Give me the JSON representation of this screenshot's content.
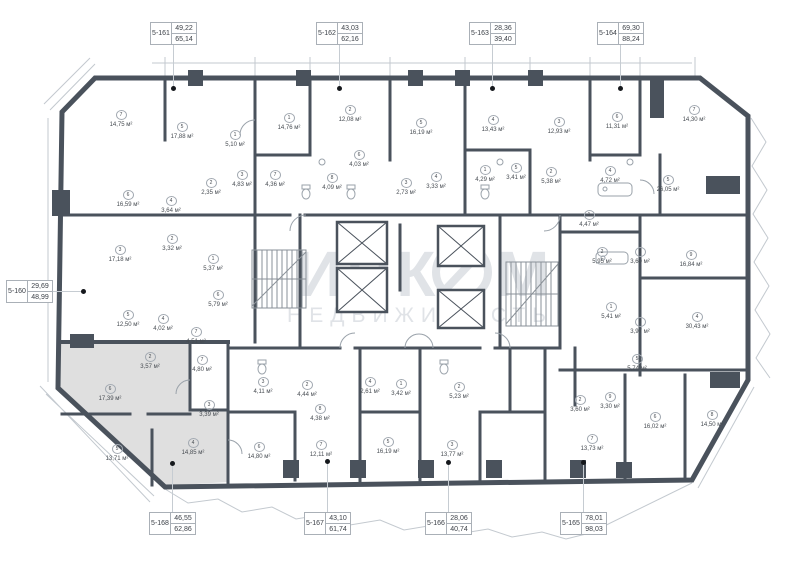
{
  "plan": {
    "area_unit": "м²",
    "watermark": {
      "brand_left": "ИНК",
      "brand_right": "М",
      "subtitle": "НЕДВИЖИМОСТЬ"
    },
    "colors": {
      "wall": "#4a525c",
      "selected_fill": "#dfdfdf",
      "leader_dot": "#15181c",
      "thin_line": "#c3c9cf"
    },
    "selected_unit": "5-168",
    "units": [
      {
        "id": "5-160",
        "living": "29,69",
        "total": "48,99",
        "box": [
          6,
          280
        ],
        "dot": [
          83,
          291
        ],
        "dir": "right"
      },
      {
        "id": "5-161",
        "living": "49,22",
        "total": "65,14",
        "box": [
          150,
          22
        ],
        "dot": [
          173,
          88
        ],
        "dir": "down"
      },
      {
        "id": "5-162",
        "living": "43,03",
        "total": "62,16",
        "box": [
          316,
          22
        ],
        "dot": [
          339,
          88
        ],
        "dir": "down"
      },
      {
        "id": "5-163",
        "living": "28,36",
        "total": "39,40",
        "box": [
          469,
          22
        ],
        "dot": [
          492,
          88
        ],
        "dir": "down"
      },
      {
        "id": "5-164",
        "living": "69,30",
        "total": "88,24",
        "box": [
          597,
          22
        ],
        "dot": [
          620,
          88
        ],
        "dir": "down"
      },
      {
        "id": "5-165",
        "living": "78,01",
        "total": "98,03",
        "box": [
          560,
          512
        ],
        "dot": [
          583,
          462
        ],
        "dir": "up"
      },
      {
        "id": "5-166",
        "living": "28,06",
        "total": "40,74",
        "box": [
          425,
          512
        ],
        "dot": [
          448,
          462
        ],
        "dir": "up"
      },
      {
        "id": "5-167",
        "living": "43,10",
        "total": "61,74",
        "box": [
          304,
          512
        ],
        "dot": [
          327,
          461
        ],
        "dir": "up"
      },
      {
        "id": "5-168",
        "living": "46,55",
        "total": "62,86",
        "box": [
          149,
          512
        ],
        "dot": [
          172,
          463
        ],
        "dir": "up"
      }
    ],
    "rooms": [
      {
        "n": "7",
        "a": "14,75",
        "x": 121,
        "y": 108
      },
      {
        "n": "5",
        "a": "17,88",
        "x": 182,
        "y": 120
      },
      {
        "n": "1",
        "a": "5,10",
        "x": 235,
        "y": 128
      },
      {
        "n": "6",
        "a": "16,59",
        "x": 128,
        "y": 188
      },
      {
        "n": "4",
        "a": "3,64",
        "x": 171,
        "y": 194
      },
      {
        "n": "2",
        "a": "2,35",
        "x": 211,
        "y": 176
      },
      {
        "n": "3",
        "a": "4,83",
        "x": 242,
        "y": 168
      },
      {
        "n": "1",
        "a": "14,76",
        "x": 289,
        "y": 111
      },
      {
        "n": "2",
        "a": "12,08",
        "x": 350,
        "y": 103
      },
      {
        "n": "5",
        "a": "16,19",
        "x": 421,
        "y": 116
      },
      {
        "n": "6",
        "a": "4,03",
        "x": 359,
        "y": 148
      },
      {
        "n": "7",
        "a": "4,36",
        "x": 275,
        "y": 168
      },
      {
        "n": "8",
        "a": "4,09",
        "x": 332,
        "y": 171
      },
      {
        "n": "3",
        "a": "2,73",
        "x": 406,
        "y": 176
      },
      {
        "n": "4",
        "a": "3,33",
        "x": 436,
        "y": 170
      },
      {
        "n": "4",
        "a": "13,43",
        "x": 493,
        "y": 113
      },
      {
        "n": "3",
        "a": "12,93",
        "x": 559,
        "y": 115
      },
      {
        "n": "6",
        "a": "11,31",
        "x": 617,
        "y": 110
      },
      {
        "n": "1",
        "a": "4,29",
        "x": 485,
        "y": 163
      },
      {
        "n": "5",
        "a": "3,41",
        "x": 516,
        "y": 161
      },
      {
        "n": "2",
        "a": "5,38",
        "x": 551,
        "y": 165
      },
      {
        "n": "4",
        "a": "4,72",
        "x": 610,
        "y": 164
      },
      {
        "n": "7",
        "a": "14,30",
        "x": 694,
        "y": 103
      },
      {
        "n": "5",
        "a": "26,05",
        "x": 668,
        "y": 173
      },
      {
        "n": "3",
        "a": "17,18",
        "x": 120,
        "y": 243
      },
      {
        "n": "2",
        "a": "3,32",
        "x": 172,
        "y": 232
      },
      {
        "n": "1",
        "a": "5,37",
        "x": 213,
        "y": 252
      },
      {
        "n": "6",
        "a": "5,79",
        "x": 218,
        "y": 288
      },
      {
        "n": "5",
        "a": "12,50",
        "x": 128,
        "y": 308
      },
      {
        "n": "4",
        "a": "4,02",
        "x": 163,
        "y": 312
      },
      {
        "n": "7",
        "a": "4,51",
        "x": 196,
        "y": 325
      },
      {
        "n": "1",
        "a": "4,47",
        "x": 589,
        "y": 208
      },
      {
        "n": "2",
        "a": "5,95",
        "x": 602,
        "y": 245
      },
      {
        "n": "3",
        "a": "3,60",
        "x": 640,
        "y": 245
      },
      {
        "n": "9",
        "a": "16,84",
        "x": 691,
        "y": 248
      },
      {
        "n": "1",
        "a": "5,41",
        "x": 611,
        "y": 300
      },
      {
        "n": "3",
        "a": "3,97",
        "x": 640,
        "y": 315
      },
      {
        "n": "4",
        "a": "30,43",
        "x": 697,
        "y": 310
      },
      {
        "n": "5",
        "a": "5,74",
        "x": 637,
        "y": 352
      },
      {
        "n": "2",
        "a": "3,60",
        "x": 580,
        "y": 393
      },
      {
        "n": "9",
        "a": "3,30",
        "x": 610,
        "y": 390
      },
      {
        "n": "7",
        "a": "13,73",
        "x": 592,
        "y": 432
      },
      {
        "n": "6",
        "a": "16,02",
        "x": 655,
        "y": 410
      },
      {
        "n": "8",
        "a": "14,50",
        "x": 712,
        "y": 408
      },
      {
        "n": "3",
        "a": "4,11",
        "x": 263,
        "y": 375
      },
      {
        "n": "2",
        "a": "4,44",
        "x": 307,
        "y": 378
      },
      {
        "n": "8",
        "a": "4,38",
        "x": 320,
        "y": 402
      },
      {
        "n": "4",
        "a": "2,61",
        "x": 370,
        "y": 375
      },
      {
        "n": "1",
        "a": "3,42",
        "x": 401,
        "y": 377
      },
      {
        "n": "2",
        "a": "5,23",
        "x": 459,
        "y": 380
      },
      {
        "n": "6",
        "a": "14,80",
        "x": 259,
        "y": 440
      },
      {
        "n": "7",
        "a": "12,11",
        "x": 321,
        "y": 438
      },
      {
        "n": "5",
        "a": "16,19",
        "x": 388,
        "y": 435
      },
      {
        "n": "3",
        "a": "13,77",
        "x": 452,
        "y": 438
      },
      {
        "n": "2",
        "a": "3,57",
        "x": 150,
        "y": 350
      },
      {
        "n": "7",
        "a": "4,80",
        "x": 202,
        "y": 353
      },
      {
        "n": "3",
        "a": "3,39",
        "x": 209,
        "y": 398
      },
      {
        "n": "6",
        "a": "17,39",
        "x": 110,
        "y": 382
      },
      {
        "n": "5",
        "a": "13,71",
        "x": 117,
        "y": 442
      },
      {
        "n": "4",
        "a": "14,85",
        "x": 193,
        "y": 436
      }
    ]
  }
}
